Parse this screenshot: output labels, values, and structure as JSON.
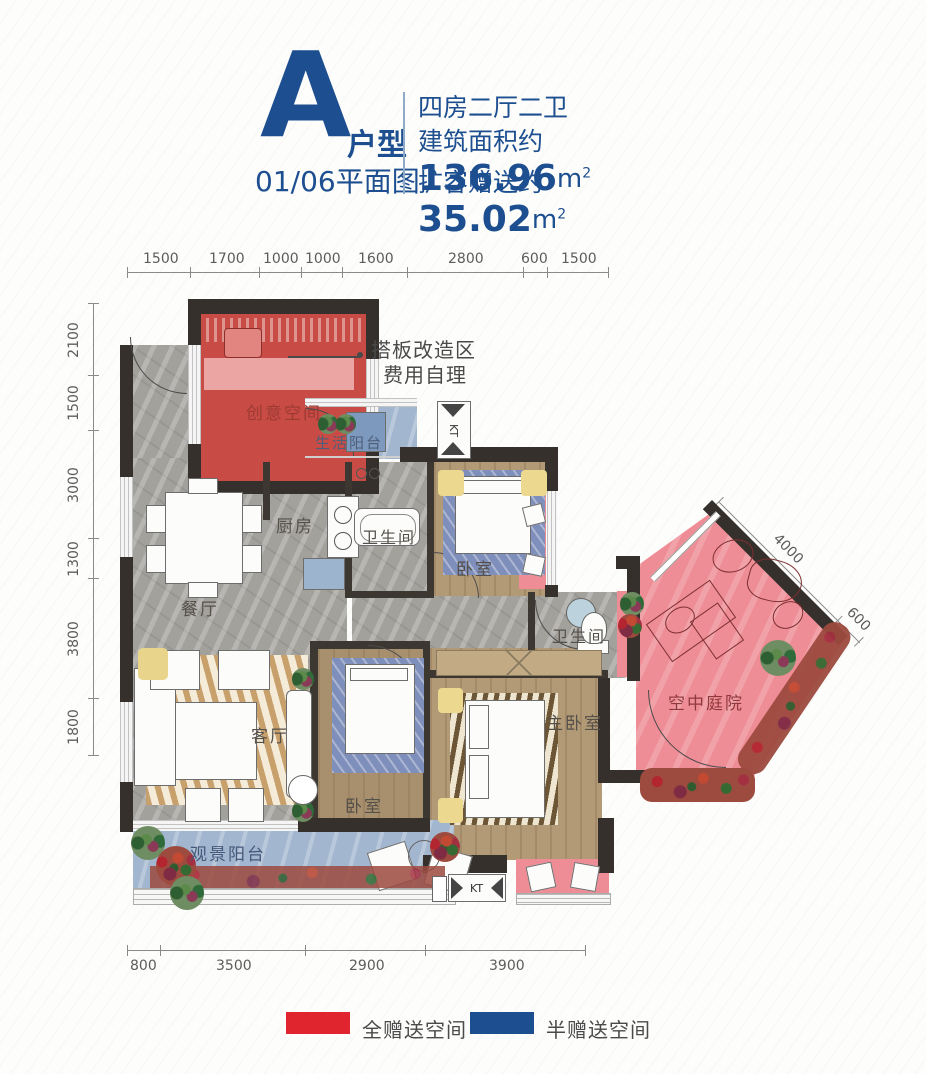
{
  "header": {
    "unit_letter": "A",
    "unit_suffix": "户型",
    "subtitle": "01/06平面图",
    "spec": "四房二厅二卫",
    "area_prefix": "建筑面积约",
    "area_value": "136.96",
    "bonus_prefix": "扩容赠送约",
    "bonus_value": "35.02",
    "unit": "m",
    "sup": "2",
    "accent_color": "#1d4f90"
  },
  "dimensions": {
    "top": [
      "1500",
      "1700",
      "1000",
      "1000",
      "1600",
      "2800",
      "600",
      "1500"
    ],
    "left": [
      "2100",
      "1500",
      "3000",
      "1300",
      "3800",
      "1800"
    ],
    "bottom": [
      "800",
      "3500",
      "2900",
      "3900"
    ],
    "diag_long": "4000",
    "diag_short": "600"
  },
  "annotation": {
    "line1": "搭板改造区",
    "line2": "费用自理"
  },
  "rooms": {
    "creative": "创意空间",
    "service_balcony": "生活阳台",
    "kitchen": "厨房",
    "bath1": "卫生间",
    "bedroom_tr": "卧室",
    "dining": "餐厅",
    "living": "客厅",
    "bath2": "卫生间",
    "master": "主卧室",
    "bedroom_ll": "卧室",
    "view_balcony": "观景阳台",
    "courtyard": "空中庭院"
  },
  "legend": {
    "full": {
      "label": "全赠送空间",
      "color": "#e0252f"
    },
    "half": {
      "label": "半赠送空间",
      "color": "#1d4f90"
    }
  },
  "labels": {
    "kt": "KT"
  }
}
